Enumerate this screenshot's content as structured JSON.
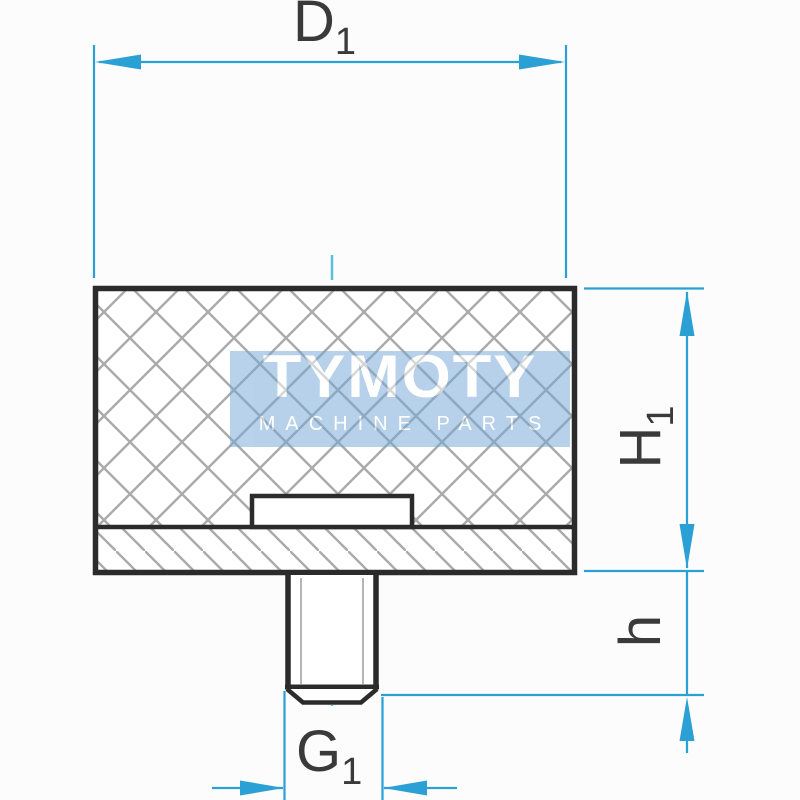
{
  "diagram": {
    "dimensions": {
      "d1": {
        "main": "D",
        "sub": "1"
      },
      "h1": {
        "main": "H",
        "sub": "1"
      },
      "h": {
        "main": "h",
        "sub": ""
      },
      "g1": {
        "main": "G",
        "sub": "1"
      }
    },
    "watermark": {
      "brand": "TYMOTY",
      "tagline": "MACHINE PARTS"
    },
    "colors": {
      "dimension_line": "#2aa0d4",
      "centerline": "#5cc0dd",
      "outline": "#2b2b2b",
      "hatch": "#aaaaaa",
      "thread_line": "#b6b6b6",
      "watermark_background": "#74a8d6",
      "label_text": "#3a3a3a",
      "background": "#fcfcfc"
    }
  }
}
